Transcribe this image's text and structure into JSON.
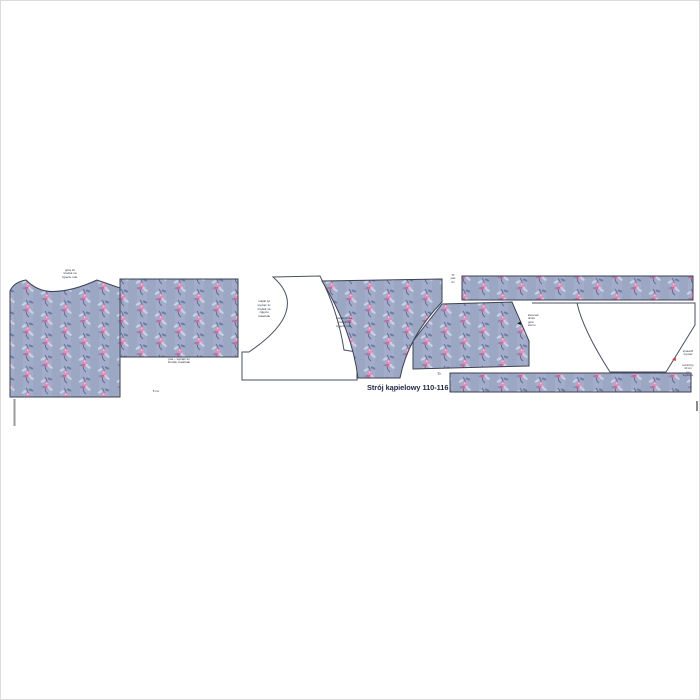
{
  "title": "Strój kąpielowy 110-116",
  "colors": {
    "fabric_base": "#9ca7c4",
    "fabric_stripe": "#a3adc9",
    "fabric_foliage_dark": "#5c6b94",
    "fabric_leaf_light": "#c9d1e4",
    "flower_pink": "#e78db7",
    "flower_deep_pink": "#d2659c",
    "piece_outline": "#3b4152",
    "arrow_red": "#e02d2d",
    "arrow_black": "#1c1c1c"
  },
  "labels": {
    "piece_top_left": [
      "góra 2x",
      "środek na",
      "zgięciu mat."
    ],
    "piece_rect_bottom": [
      "pas – wyciąć 1x",
      "środek materiału"
    ],
    "piece_white_center": [
      "majtki tył",
      "wyciąć 1x",
      "środek na",
      "zgięciu",
      "materiału"
    ],
    "piece_fabric_bottoms": [
      "majtki przód",
      "środek na",
      "zgięciu mat."
    ],
    "strip_note": [
      "Tł:",
      "pas",
      "2x"
    ],
    "fold_mark": "Tł:",
    "small_note": "5 cm",
    "black_arrow_note": [
      "kierunek",
      "druku",
      "góra",
      "wzoru"
    ],
    "red_arrow_note": [
      "sprawdź",
      "wymiar",
      "kontrolny",
      "10 cm",
      "po",
      "wydruku"
    ]
  },
  "icons": {
    "black_arrow": "◄",
    "red_arrow": "◄"
  }
}
